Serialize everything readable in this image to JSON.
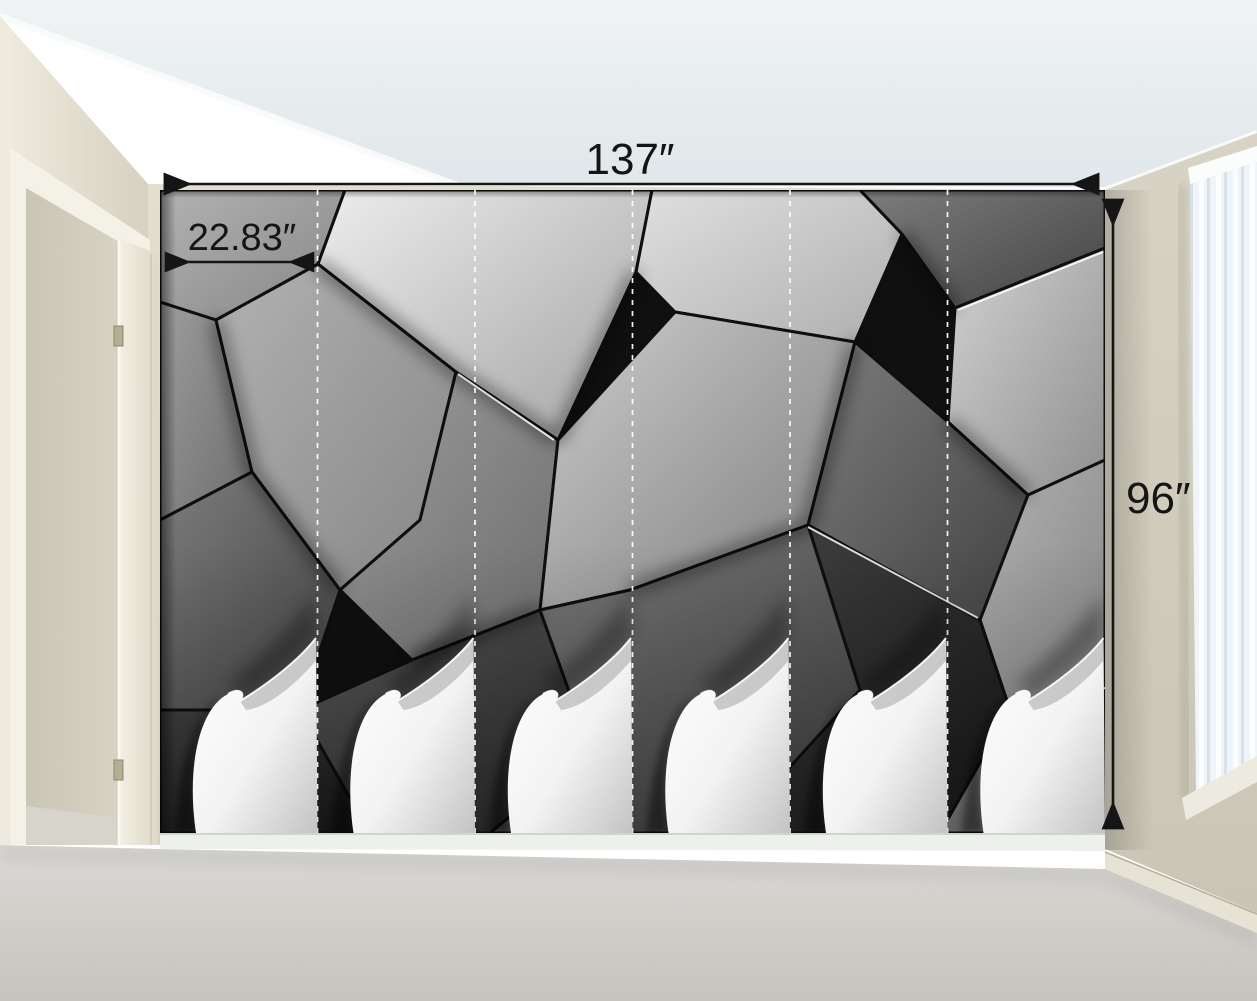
{
  "product_mockup": {
    "description": "Room mockup of a 3D grey geometric polygon wall mural with peeling panel corners",
    "dimensions": {
      "width_label": "137″",
      "height_label": "96″",
      "panel_width_label": "22.83″"
    },
    "panel_count": 6
  },
  "palette": {
    "annotation_ink": "#151515",
    "wall_beige": "#ddd8c7",
    "left_wall_cream": "#e9e5d7",
    "ceiling": "#e9eef0",
    "carpet": "#d4d1cc",
    "mural_light": "#e8e8e8",
    "mural_dark": "#1c1c1c",
    "paper_back": "#ffffff",
    "blinds": "#eef4f7"
  }
}
